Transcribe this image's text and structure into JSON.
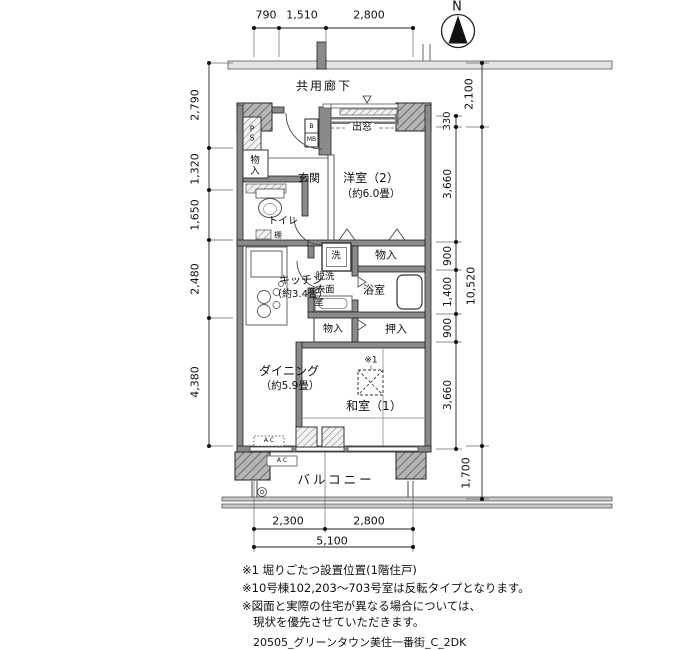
{
  "compass": {
    "north_label": "N"
  },
  "corridor_label": "共用廊下",
  "balcony_label": "バルコニー",
  "rooms": {
    "bay_window": "出窓",
    "western2_name": "洋室（2）",
    "western2_size": "（約6.0畳）",
    "genkan": "玄関",
    "ps": "PS",
    "meter_b": "B",
    "meter_mb": "MB",
    "monoire_genkan": "物入",
    "toilet": "トイレ",
    "shelf": "棚",
    "kitchen_name": "キッチン",
    "kitchen_size": "（約3.4畳）",
    "laundry": "洗",
    "washroom_line1": "脱洗",
    "washroom_line2": "衣面",
    "washroom_line3": "室",
    "monoire_upper": "物入",
    "bath": "浴室",
    "monoire_lower": "物入",
    "oshiire": "押入",
    "dining_name": "ダイニング",
    "dining_size": "（約5.9畳）",
    "washitsu_name": "和室（1）",
    "kotatsu_note_mark": "※1",
    "ac_unit_inner": "A C",
    "ac_unit_outer": "A C"
  },
  "dimensions": {
    "top": [
      "790",
      "1,510",
      "2,800"
    ],
    "left": [
      "2,790",
      "1,320",
      "1,650",
      "2,480",
      "4,380"
    ],
    "right_inner": [
      "330",
      "3,660",
      "900",
      "1,400",
      "900",
      "3,660"
    ],
    "right_outer": [
      "2,100",
      "10,520",
      "1,700"
    ],
    "bottom": [
      "2,300",
      "2,800"
    ],
    "bottom_total": "5,100"
  },
  "notes": [
    "※1 堀りごたつ設置位置(1階住戸)",
    "※10号棟102,203〜703号室は反転タイプとなります。",
    "※図面と実際の住宅が異なる場合については、",
    "現状を優先させていただきます。"
  ],
  "drawing_code": "20505_グリーンタウン美住一番街_C_2DK",
  "colors": {
    "line": "#222222",
    "wall_fill": "#8a8a8a",
    "hatch_fill": "#c8c8c8"
  }
}
